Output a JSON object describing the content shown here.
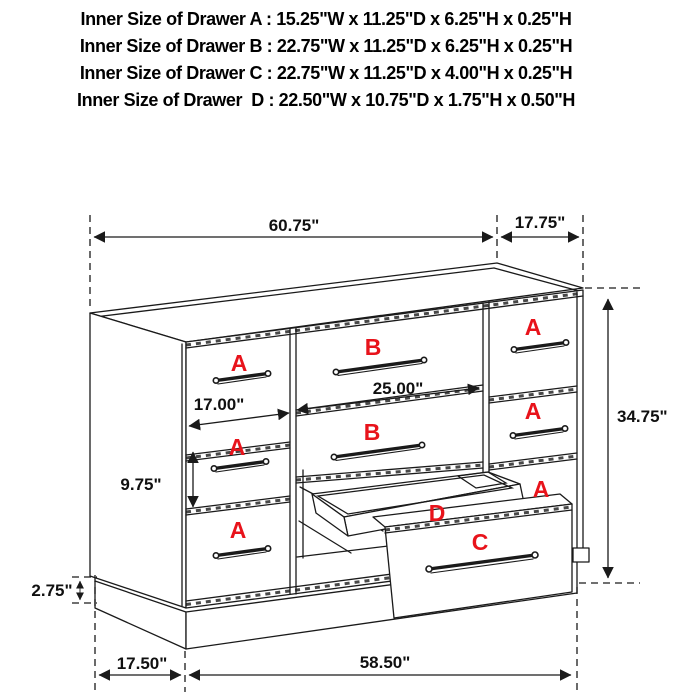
{
  "spec_header": {
    "lines": [
      "Inner Size of Drawer A : 15.25\"W x 11.25\"D x 6.25\"H x 0.25\"H",
      "Inner Size of Drawer B : 22.75\"W x 11.25\"D x 6.25\"H x 0.25\"H",
      "Inner Size of Drawer C : 22.75\"W x 11.25\"D x 4.00\"H x 0.25\"H",
      "Inner Size of Drawer  D : 22.50\"W x 10.75\"D x 1.75\"H x 0.50\"H"
    ]
  },
  "dimensions": {
    "top_width": "60.75\"",
    "top_depth": "17.75\"",
    "overall_height": "34.75\"",
    "drawer_b_width": "25.00\"",
    "drawer_a_width": "17.00\"",
    "drawer_a_height": "9.75\"",
    "base_height": "2.75\"",
    "base_side_depth": "17.50\"",
    "base_front_width": "58.50\""
  },
  "drawer_labels": {
    "a": "A",
    "b": "B",
    "c": "C",
    "d": "D"
  },
  "colors": {
    "label_red": "#e8131b",
    "ink": "#1a1a1a"
  }
}
